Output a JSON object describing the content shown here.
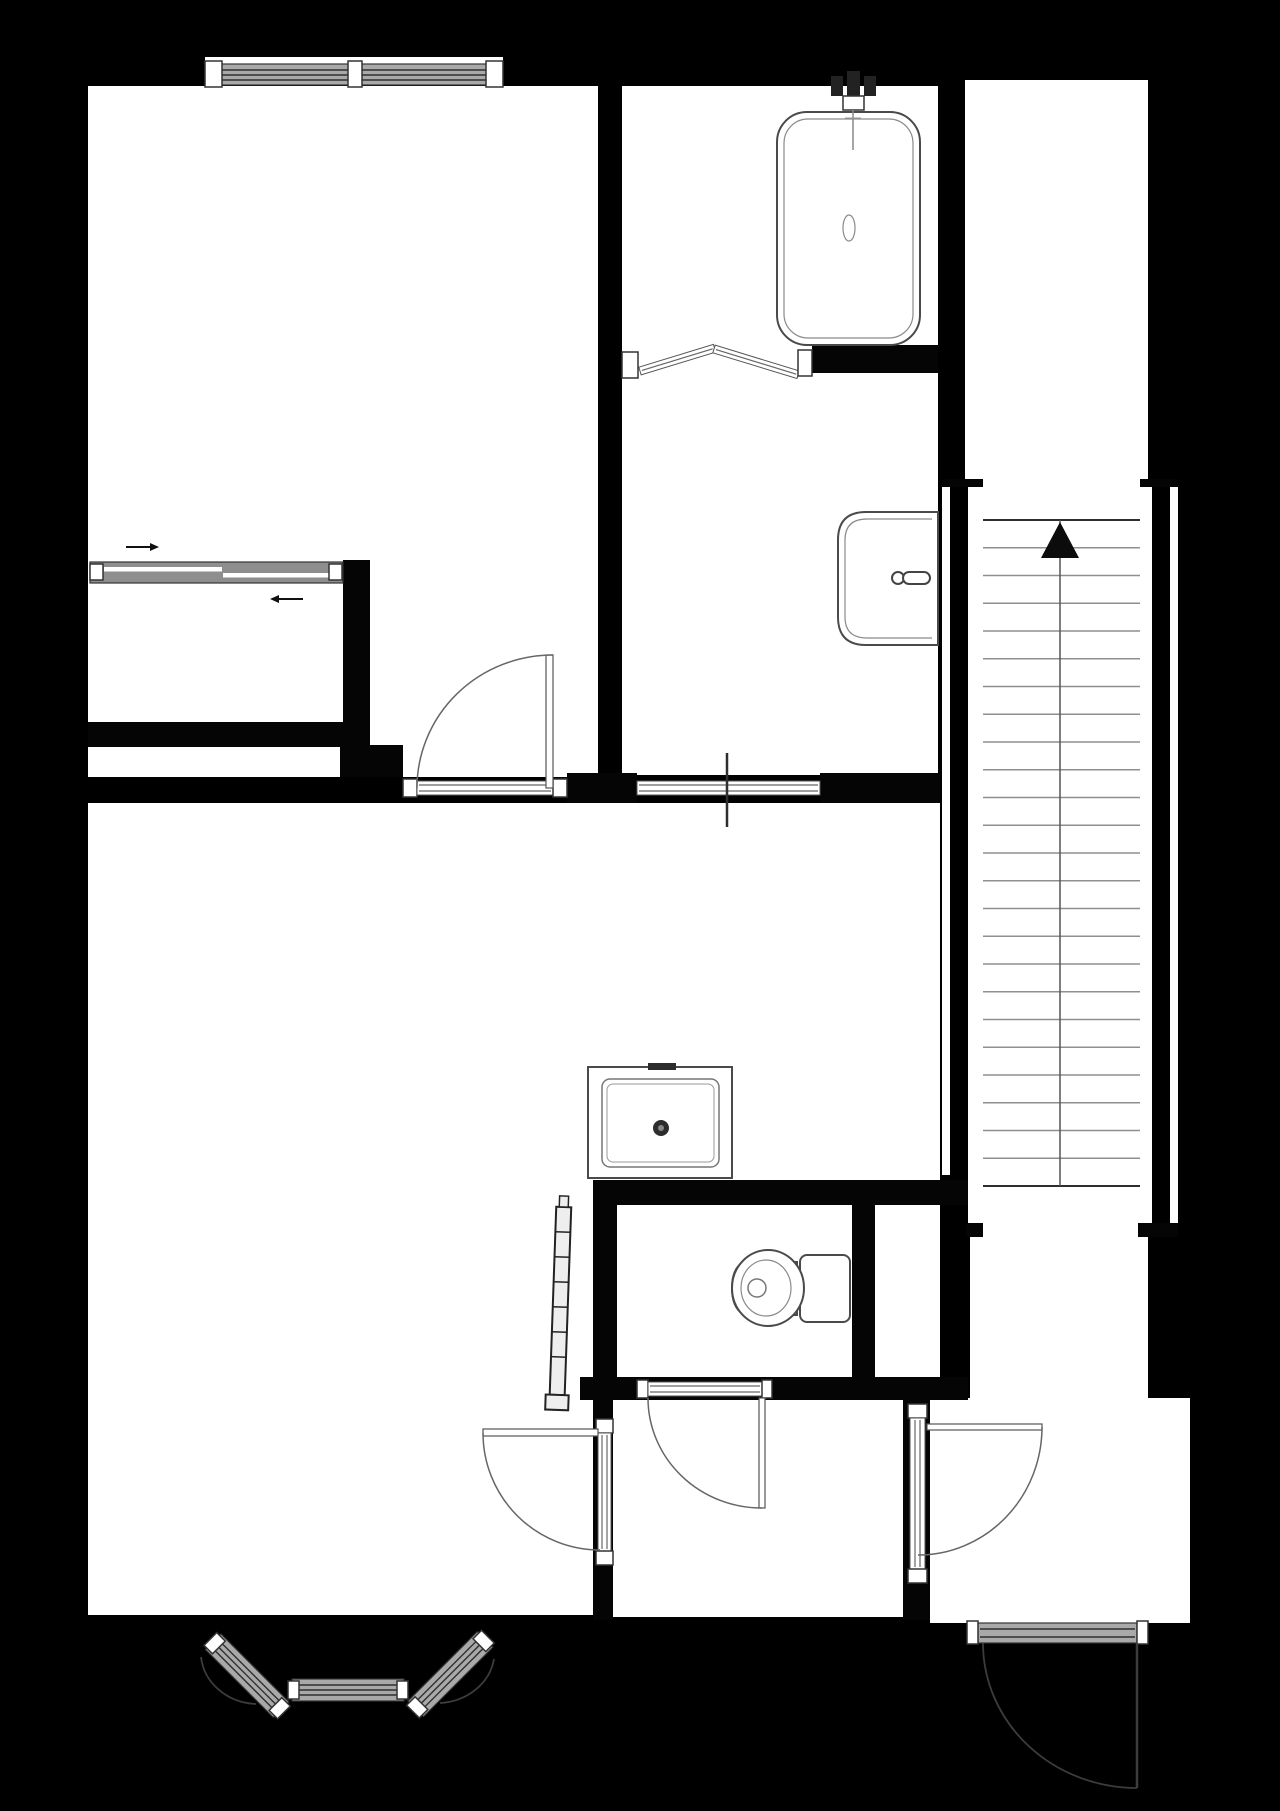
{
  "colors": {
    "background": "#000000",
    "floor": "#ffffff",
    "wall": "#050505",
    "fixture_line": "#4a4a4a",
    "window_band": "#a9a9a9"
  },
  "stairs": {
    "direction_arrow": "up",
    "tread_count": 25,
    "x1": 983,
    "x2": 1140,
    "y_top": 520,
    "y_bottom": 1186,
    "center_x": 1060
  },
  "closet_slider": {
    "upper_arrow_direction": "right",
    "lower_arrow_direction": "left",
    "leaf_count": 2
  },
  "fixtures": [
    "bathtub",
    "bathtub-faucet",
    "bifold-shower-door",
    "wall-hung-sink",
    "shower-tray-with-drain",
    "toilet-with-cistern",
    "radiator",
    "bay-window-3-panes",
    "bedroom-window-2-panes",
    "entry-window",
    "exterior-door-swing",
    "interior-doors"
  ],
  "doors": {
    "bedroom_door": "swings north into bedroom",
    "living_room_door": "swings west into living room",
    "toilet_door": "swings south into vestibule",
    "hall_door": "swings east into entry room",
    "front_door": "swings outward (south)"
  }
}
